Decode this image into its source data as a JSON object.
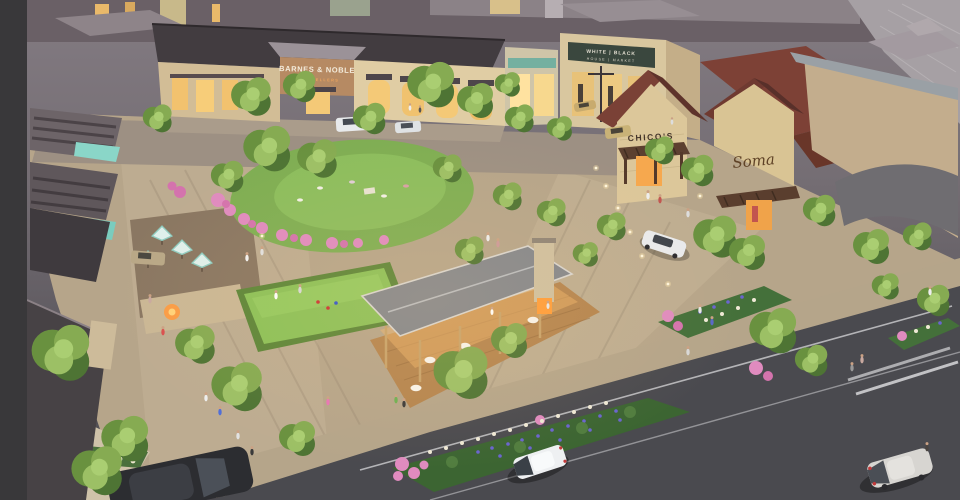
{
  "scene": {
    "description": "Aerial dusk rendering of an open-air lifestyle shopping center with a central lawn, bocce court, outdoor dining pavilion, umbrella patio, landscaped flower beds and a tree-lined street with cars",
    "media_type": "architectural rendering"
  },
  "signs": {
    "barnes_noble": "BARNES & NOBLE",
    "barnes_noble_sub": "BOOKSELLERS",
    "whbm_line1": "WHITE | BLACK",
    "whbm_line2": "HOUSE | MARKET",
    "chicos": "CHICO'S",
    "soma": "Soma"
  },
  "palette": {
    "letterbox": "#39383a",
    "dusk_rooftop": "#6a6066",
    "asphalt": "#4a4a4f",
    "limestone": "#d9c79f",
    "roof_redbrown": "#7d4136",
    "lawn_green": "#7fae53",
    "tree_green": "#6f9a45",
    "warm_window": "#f2c26e",
    "teal_awning": "#8ad6c8",
    "azalea_pink": "#e08bbf",
    "bluebonnet": "#6a64d0"
  }
}
